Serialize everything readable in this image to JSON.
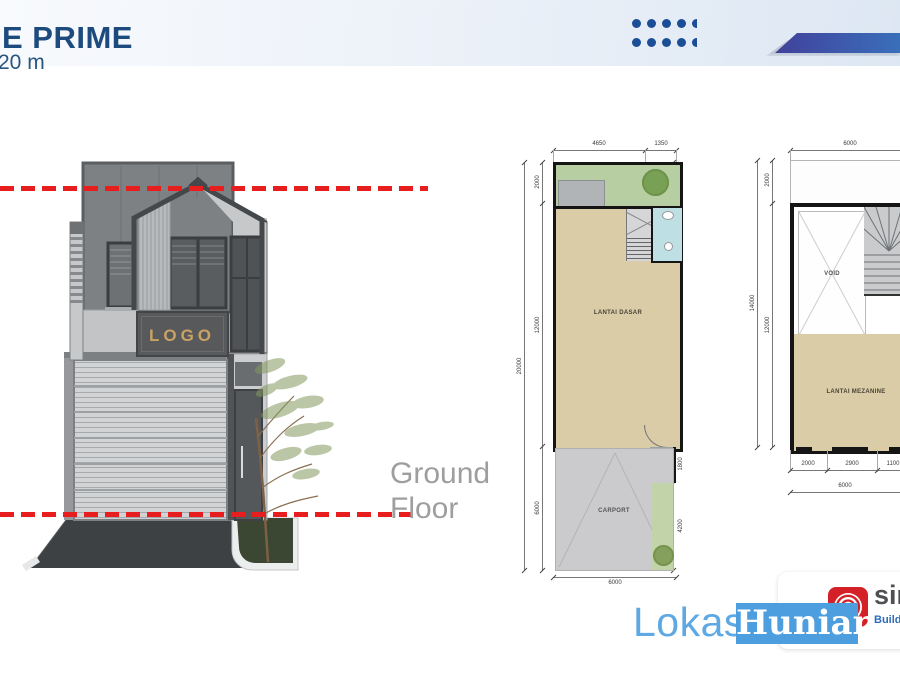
{
  "header": {
    "title": "E PRIME",
    "subtitle": "20 m"
  },
  "annotations": {
    "ground_floor": [
      "Ground",
      "Floor"
    ]
  },
  "render": {
    "logo_sign": "LOGO"
  },
  "plan_ground": {
    "labels": {
      "floor": "LANTAI DASAR",
      "teras": "TERAS",
      "carport": "CARPORT"
    },
    "dims": {
      "top": [
        "4650",
        "1350"
      ],
      "left_outer": "20000",
      "left_inner": [
        "2000",
        "12000",
        "6000"
      ],
      "right": [
        "2000",
        "2750",
        "9250",
        "1800",
        "4200"
      ],
      "bottom": "6000"
    }
  },
  "plan_mezzanine": {
    "labels": {
      "void": "VOID",
      "floor": "LANTAI MEZANINE"
    },
    "dims": {
      "top": "6000",
      "left_outer": "14000",
      "left_inner": [
        "2000",
        "12000"
      ],
      "bottom_segments": [
        "2000",
        "2900",
        "1100"
      ],
      "bottom_total": "6000"
    }
  },
  "watermark": {
    "part1": "Lokasi",
    "part2": "Hunian"
  },
  "vendor": {
    "name_fragment": "sin",
    "tagline_fragment": "Buildin"
  },
  "colors": {
    "brand_navy": "#1d4b7d",
    "accent_red_dashline": "#e81d1d",
    "dots_blue": "#1b4e96",
    "ribbon_start": "#41419b",
    "ribbon_end": "#3a6fba",
    "watermark_blue": "#4d9edf",
    "vendor_red": "#d42127",
    "vendor_tag_blue": "#2a6cb8",
    "plan_floor_tan": "#d9cca7",
    "plan_garden_green": "#b7cda2",
    "plan_bath_blue": "#bedfe3"
  }
}
